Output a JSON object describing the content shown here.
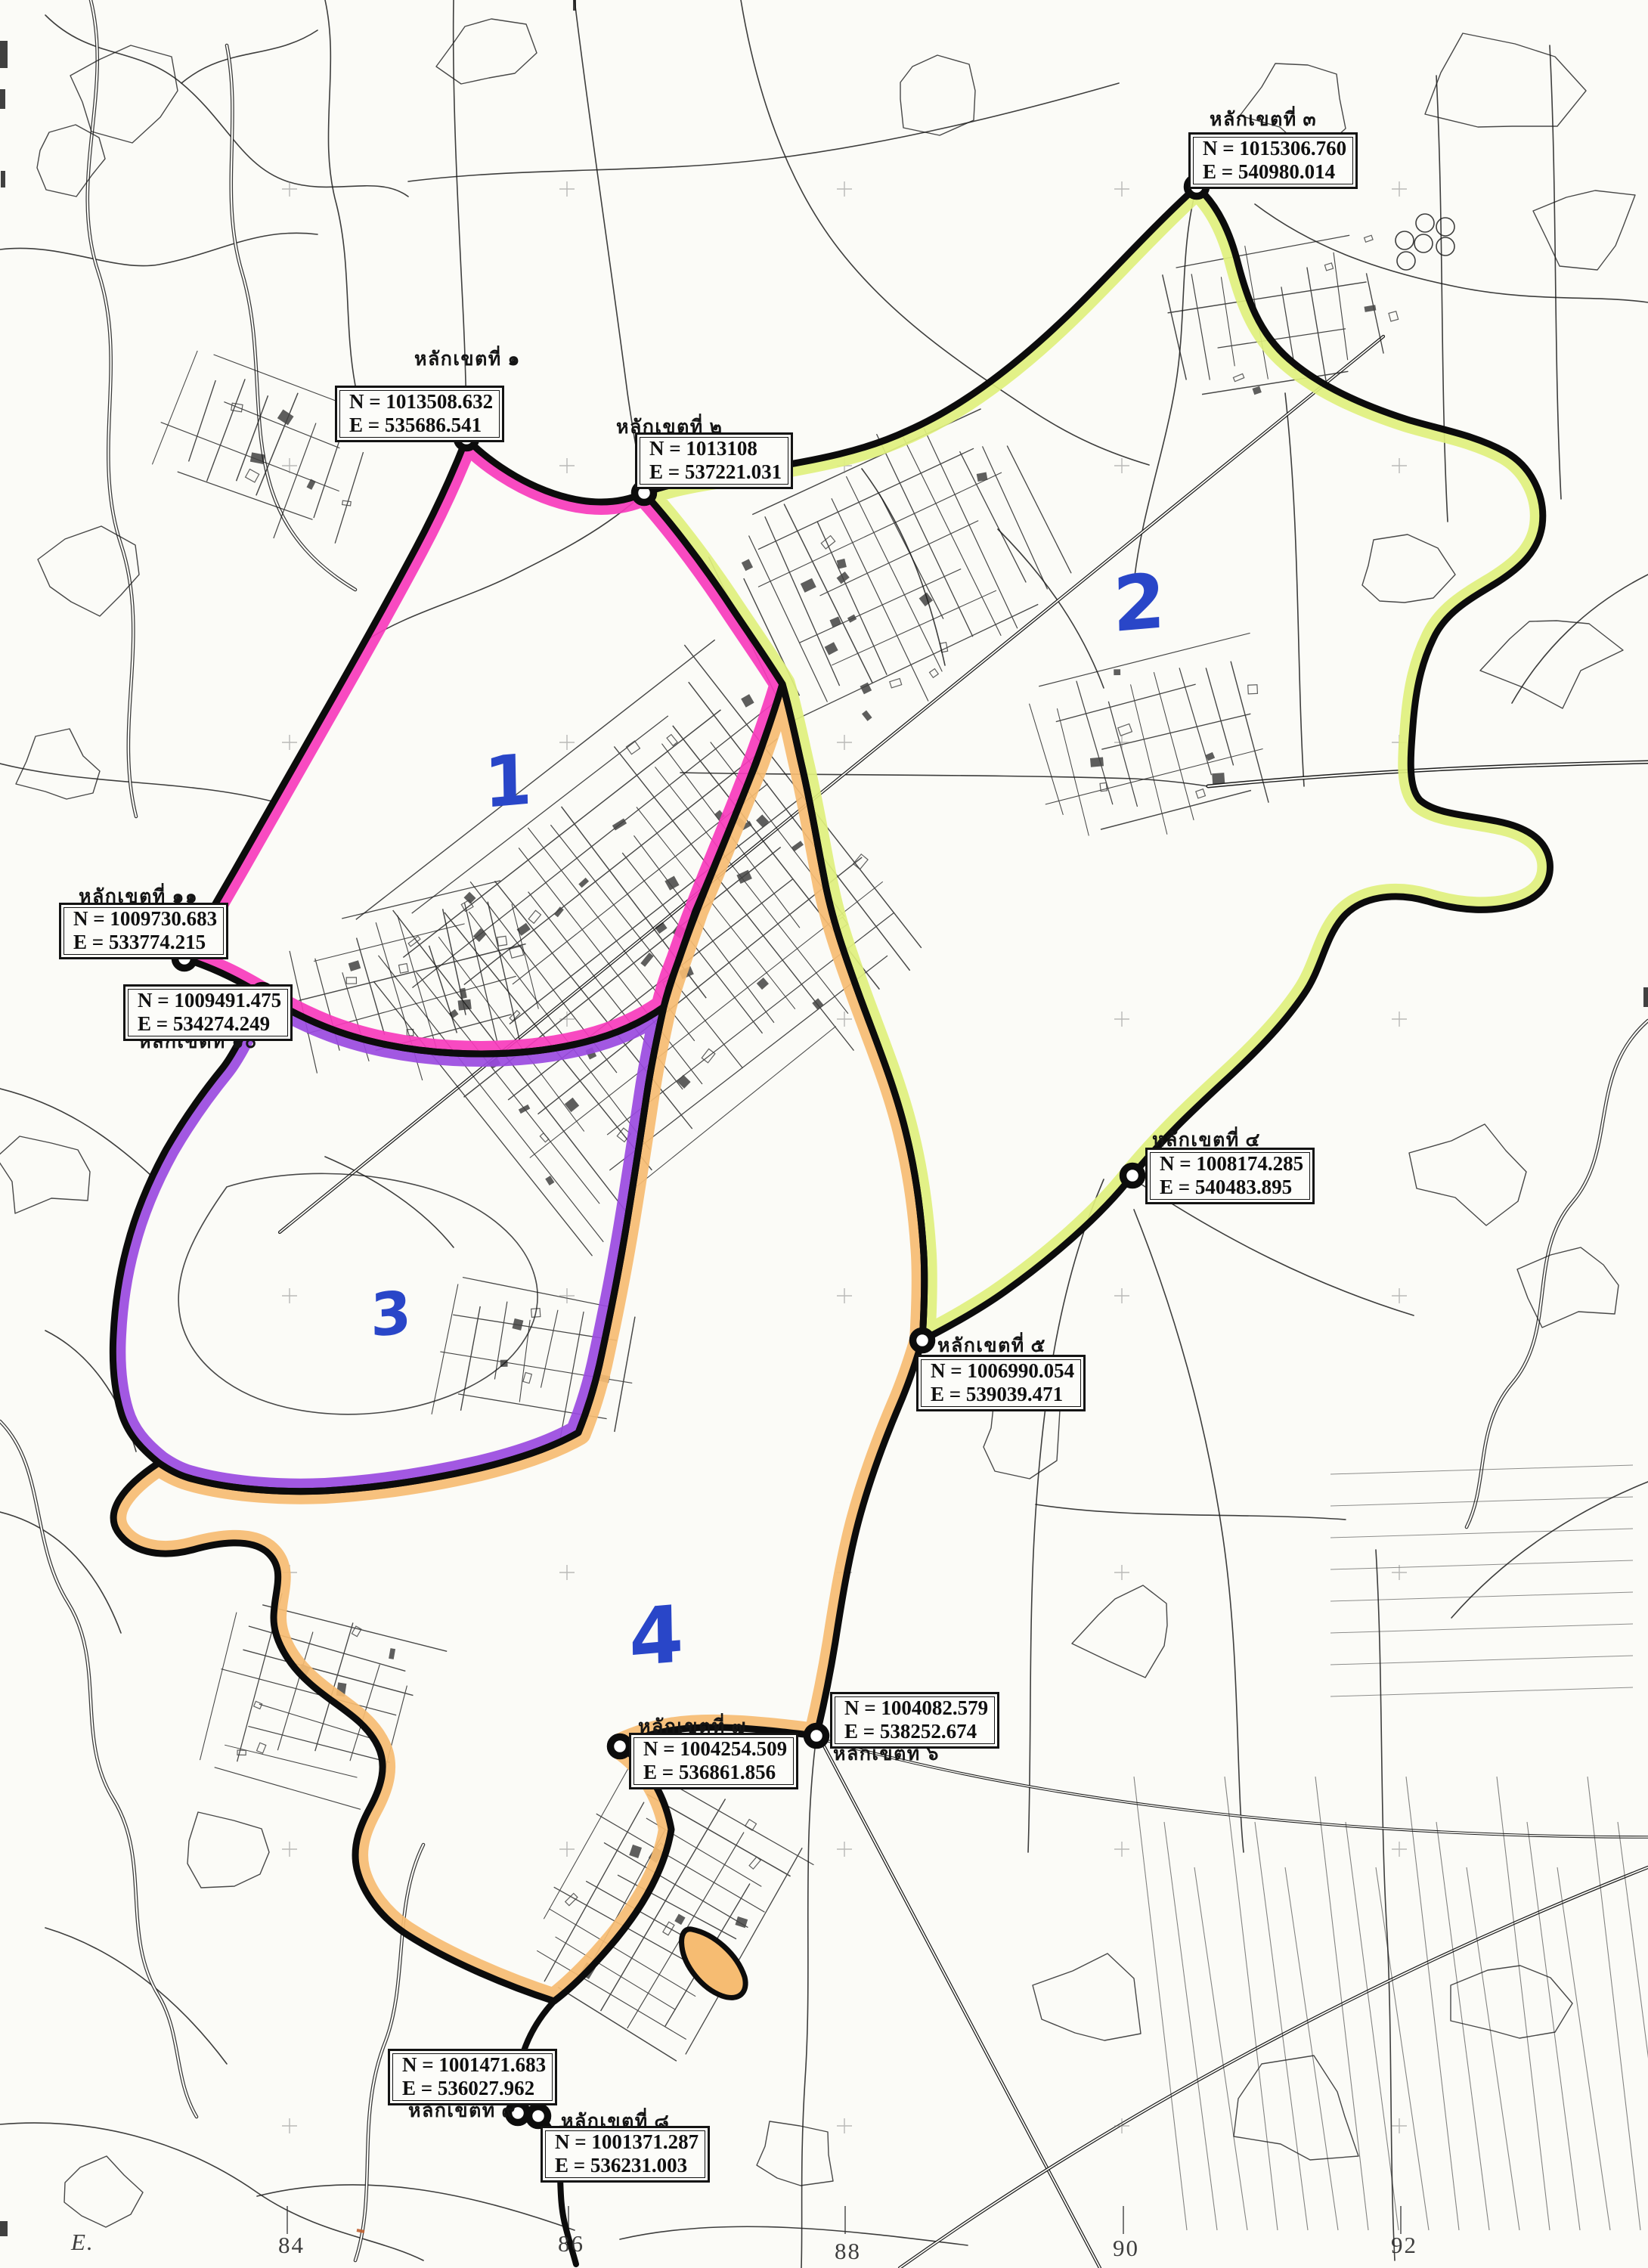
{
  "map": {
    "description_label": "",
    "colors": {
      "zone1_band": "#f73bbc",
      "zone2_band": "#dff07d",
      "zone3_band": "#9a4ae0",
      "zone4_band": "#f6bc72",
      "boundary_line": "#0c0c0c",
      "marker_dot_fill": "#ffffff",
      "handwritten_blue": "#2946c8",
      "map_linework": "#1c1c1c",
      "paper": "#fbfbf7",
      "red_tick": "#c06030"
    },
    "zone_numbers": [
      {
        "label": "1"
      },
      {
        "label": "2"
      },
      {
        "label": "3"
      },
      {
        "label": "4"
      }
    ],
    "markers": [
      {
        "no": 1,
        "title": "หลักเขตที่ ๑",
        "n": "N = 1013508.632",
        "e": "E = 535686.541"
      },
      {
        "no": 2,
        "title": "หลักเขตที่ ๒",
        "n": "N = 1013108",
        "e": "E = 537221.031"
      },
      {
        "no": 3,
        "title": "หลักเขตที่ ๓",
        "n": "N = 1015306.760",
        "e": "E = 540980.014"
      },
      {
        "no": 4,
        "title": "หลักเขตที่ ๔",
        "n": "N = 1008174.285",
        "e": "E = 540483.895"
      },
      {
        "no": 5,
        "title": "หลักเขตที่ ๕",
        "n": "N = 1006990.054",
        "e": "E = 539039.471"
      },
      {
        "no": 6,
        "title": "หลักเขตที่ ๖",
        "n": "N = 1004082.579",
        "e": "E = 538252.674"
      },
      {
        "no": 7,
        "title": "หลักเขตที่ ๗",
        "n": "N = 1004254.509",
        "e": "E = 536861.856"
      },
      {
        "no": 8,
        "title": "หลักเขตที่ ๘",
        "n": "N = 1001371.287",
        "e": "E = 536231.003"
      },
      {
        "no": 9,
        "title": "หลักเขตที่ ๙",
        "n": "N = 1001471.683",
        "e": "E = 536027.962"
      },
      {
        "no": 10,
        "title": "หลักเขตที่ ๑๐",
        "n": "N = 1009491.475",
        "e": "E = 534274.249"
      },
      {
        "no": 11,
        "title": "หลักเขตที่ ๑๑",
        "n": "N = 1009730.683",
        "e": "E = 533774.215"
      }
    ],
    "grid": {
      "axis_label": "E.",
      "easting_labels": [
        "84",
        "86",
        "88",
        "90",
        "92"
      ]
    }
  }
}
